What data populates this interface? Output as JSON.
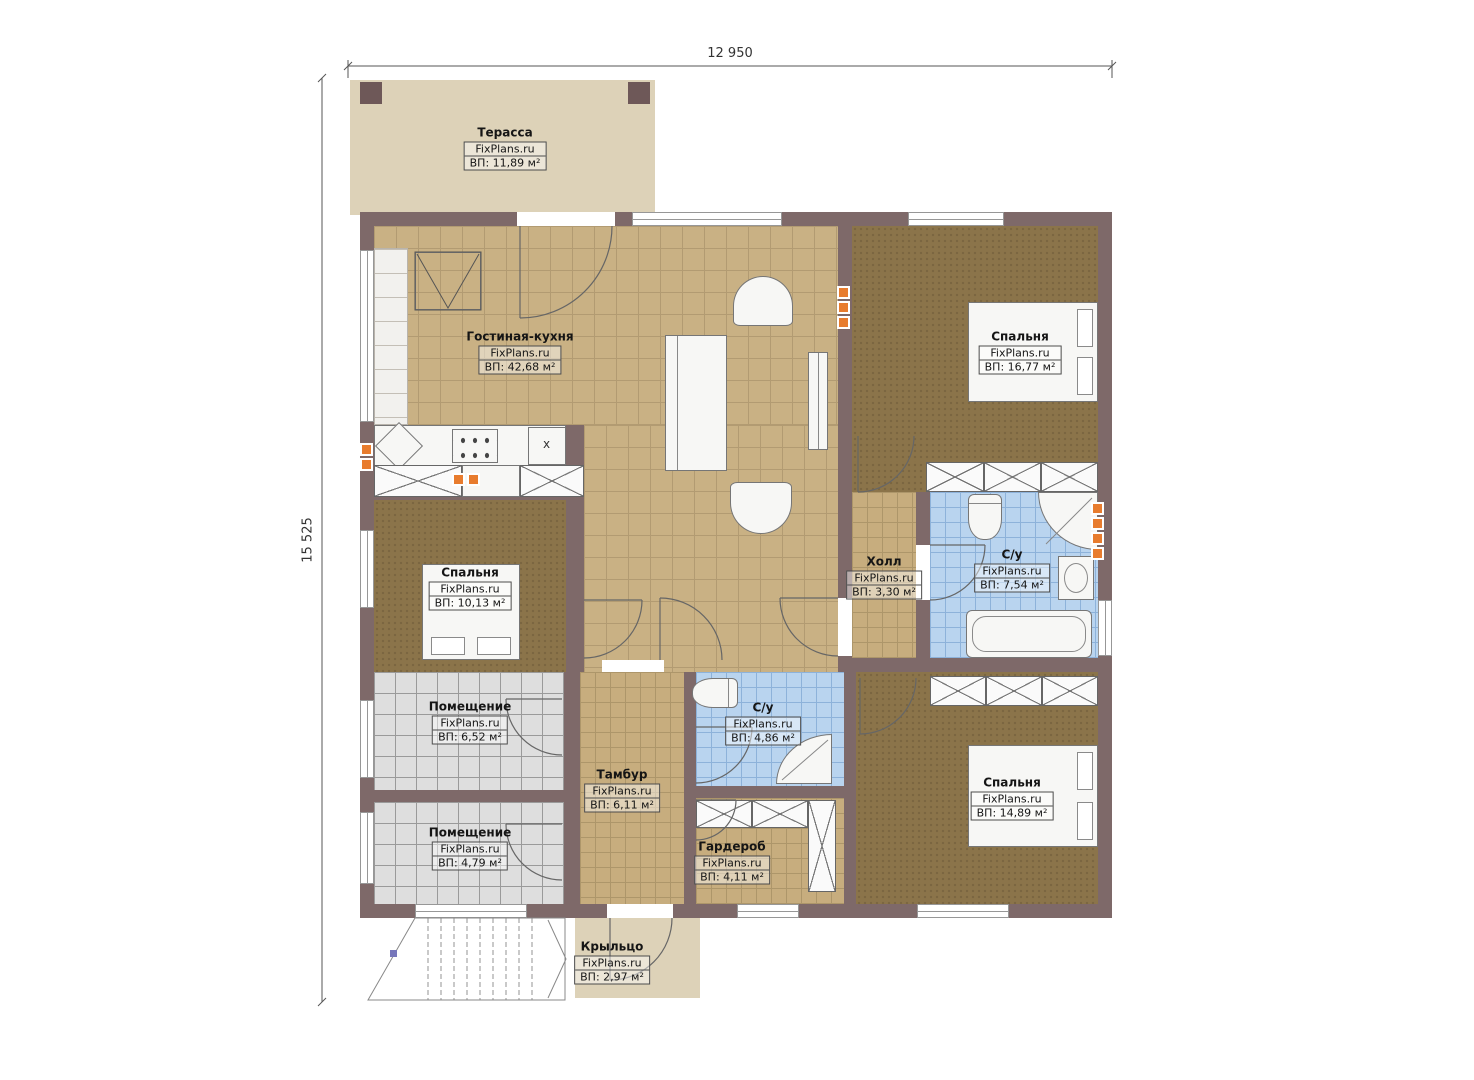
{
  "branding": "FixPlans.ru",
  "dimensions": {
    "width": "12 950",
    "height": "15 525"
  },
  "rooms": [
    {
      "name": "Терасса",
      "area": "ВП: 11,89 м²"
    },
    {
      "name": "Гостиная-кухня",
      "area": "ВП: 42,68 м²"
    },
    {
      "name": "Спальня",
      "area": "ВП: 16,77 м²"
    },
    {
      "name": "Спальня",
      "area": "ВП: 10,13 м²"
    },
    {
      "name": "Холл",
      "area": "ВП: 3,30 м²"
    },
    {
      "name": "С/у",
      "area": "ВП: 7,54 м²"
    },
    {
      "name": "Помещение",
      "area": "ВП: 6,52 м²"
    },
    {
      "name": "Помещение",
      "area": "ВП: 4,79 м²"
    },
    {
      "name": "Тамбур",
      "area": "ВП: 6,11 м²"
    },
    {
      "name": "С/у",
      "area": "ВП: 4,86 м²"
    },
    {
      "name": "Гардероб",
      "area": "ВП: 4,11 м²"
    },
    {
      "name": "Спальня",
      "area": "ВП: 14,89 м²"
    },
    {
      "name": "Крыльцо",
      "area": "ВП: 2,97 м²"
    }
  ],
  "markers": {
    "kitchen_sink": "x"
  },
  "colors": {
    "wall": "#7e6969",
    "floor_living": "#c9b184",
    "floor_bedroom": "#8b744a",
    "floor_bath": "#b9d4ef",
    "floor_utility": "#dedede",
    "terrace": "#ddd2b8",
    "radiator": "#e87c2e"
  }
}
